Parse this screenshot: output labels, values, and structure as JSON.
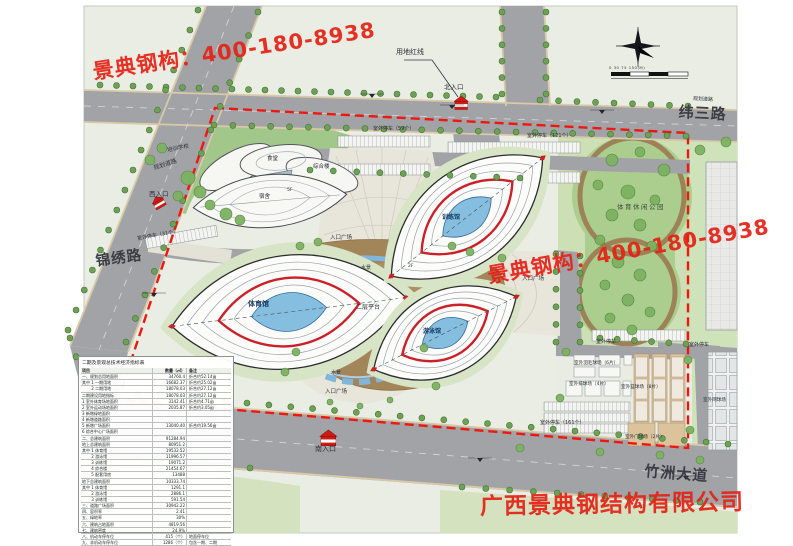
{
  "watermarks": {
    "hotline": "景典钢构：400-180-8938",
    "company": "广西景典钢结构有限公司"
  },
  "roads": {
    "weisan": "纬三路",
    "jinxiu": "锦绣路",
    "zhuzhou": "竹洲大道",
    "planned_top": "规划道路",
    "planned_west": "规划道路"
  },
  "entrances": {
    "north": "北入口",
    "west": "西入口",
    "south": "南入口"
  },
  "annotations": {
    "red_line": "用地红线",
    "scale_ticks": "0  30  75   150(M)",
    "platform": "二层平台",
    "floor_5f": "5F",
    "floor_2f": "2F",
    "entry_plaza": "入口广场",
    "water": "水景",
    "park": "体育休闲公园"
  },
  "buildings": {
    "gym": "体育馆",
    "training": "训练馆",
    "swim": "游泳馆",
    "school": "培训学校",
    "canteen": "食堂",
    "complex": "综合楼",
    "dorm": "宿舍"
  },
  "facilities": {
    "parking31": "室外停车（31个）",
    "parking59": "室外停车（59个）",
    "parking121": "室外停车（121个）",
    "parking161": "室外停车（161个）",
    "parking_a": "室外停车",
    "parking_b": "室外停车",
    "badminton": "室外羽毛球场（6片）",
    "volleyball": "室外排球场（4片）",
    "basketball": "室外篮球场（8片）",
    "gateball": "室外门球场（2片）",
    "tennis": "室外网球场"
  },
  "table": {
    "title": "二期及景观总技术经济指标表",
    "headers": [
      "项目",
      "数量（㎡）",
      "备注"
    ],
    "rows": [
      {
        "c1": "一、规划总用地面积",
        "c2": "34760.4",
        "c3": "折合约52.14亩"
      },
      {
        "c1": "其中 1 一期用地",
        "c2": "16682.37",
        "c3": "折合约25.02亩"
      },
      {
        "c1": "　　 2 二期用地",
        "c2": "18078.03",
        "c3": "折合约27.12亩"
      },
      {
        "c1": "二期建设用地指标",
        "c2": "18078.03",
        "c3": "折合约27.12亩"
      },
      {
        "c1": "1 室外体育场地面积",
        "c2": "3142.41",
        "c3": "折合约4.71亩"
      },
      {
        "c1": "2 室外运动场地面积",
        "c2": "2035.87",
        "c3": "折合约3.05亩"
      },
      {
        "c1": "3 新增绿地面积",
        "c2": "",
        "c3": ""
      },
      {
        "c1": "4 新增道路面积",
        "c2": "",
        "c3": ""
      },
      {
        "c1": "5 新增广场面积",
        "c2": "13040.40",
        "c3": "折合约19.56亩"
      },
      {
        "c1": "6 综合中心广场面积",
        "c2": "",
        "c3": ""
      },
      {
        "c1": "二、总建筑面积",
        "c2": "91284.94",
        "c3": ""
      },
      {
        "c1": "地上总建筑面积",
        "c2": "80951.2",
        "c3": ""
      },
      {
        "c1": "其中 1 体育馆",
        "c2": "19532.52",
        "c3": ""
      },
      {
        "c1": "　　 2 游泳馆",
        "c2": "11996.57",
        "c3": ""
      },
      {
        "c1": "　　 3 训练馆",
        "c2": "19071.2",
        "c3": ""
      },
      {
        "c1": "　　 4 综合楼",
        "c2": "21454.67",
        "c3": ""
      },
      {
        "c1": "　　 5 配套用房",
        "c2": "13488",
        "c3": ""
      },
      {
        "c1": "地下总建筑面积",
        "c2": "10333.74",
        "c3": ""
      },
      {
        "c1": "其中 1 体育馆",
        "c2": "1291.1",
        "c3": ""
      },
      {
        "c1": "　　 2 游泳馆",
        "c2": "2886.1",
        "c3": ""
      },
      {
        "c1": "　　 3 训练馆",
        "c2": "591.54",
        "c3": ""
      },
      {
        "c1": "三、道路广场面积",
        "c2": "30942.22",
        "c3": ""
      },
      {
        "c1": "四、容积率",
        "c2": "2.41",
        "c3": ""
      },
      {
        "c1": "五、绿地率",
        "c2": "30%",
        "c3": ""
      },
      {
        "c1": "六、建筑占地面积",
        "c2": "4819.56",
        "c3": ""
      },
      {
        "c1": "七、建筑密度",
        "c2": "24.9%",
        "c3": ""
      },
      {
        "c1": "八、机动车停车位",
        "c2": "415（个）",
        "c3": "地面停车位"
      },
      {
        "c1": "九、非机动车停车位",
        "c2": "1286（个）",
        "c3": "包含一期、二期"
      }
    ]
  },
  "colors": {
    "watermark_red": "#e42116",
    "boundary_red": "#ee1810",
    "road_gray": "#a1a3a7",
    "park_green": "#abce8e",
    "stadium_ring_red": "#cb2028",
    "water_blue": "#85bede",
    "platform_brown": "#a3855a"
  }
}
